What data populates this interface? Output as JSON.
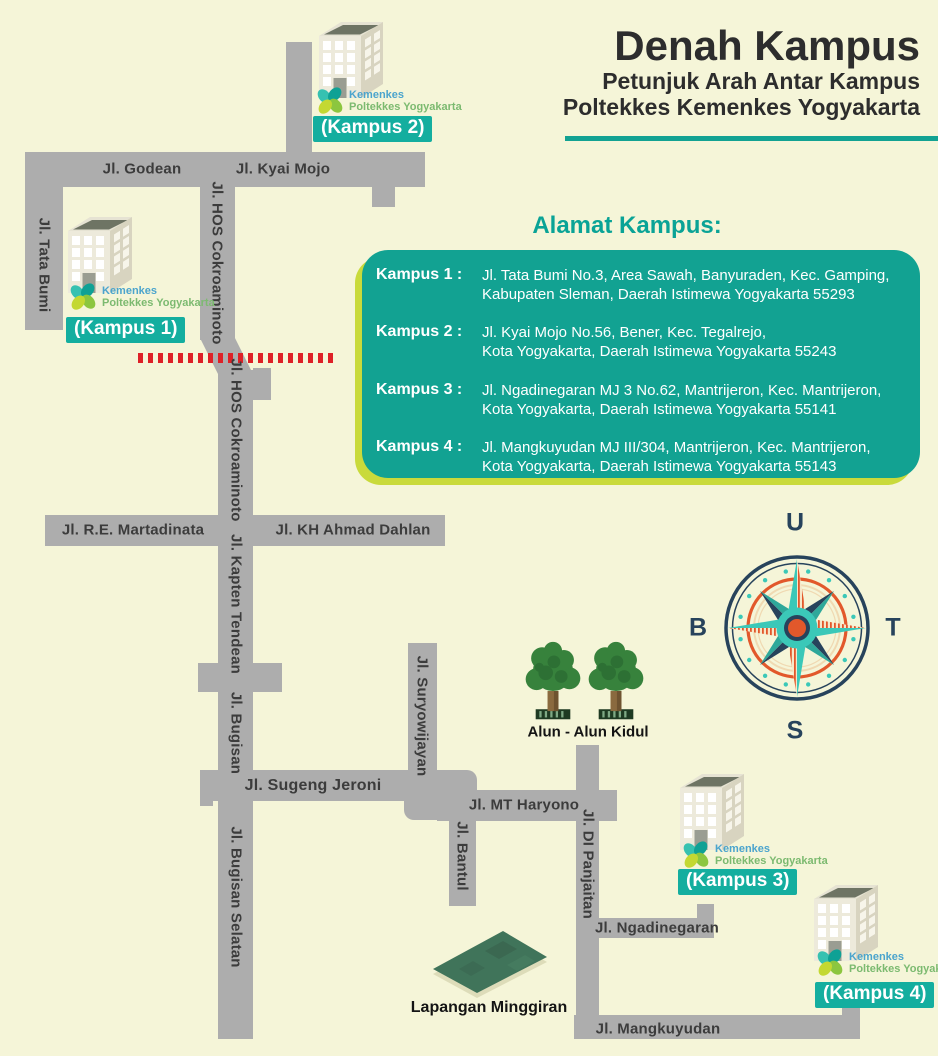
{
  "header": {
    "title": "Denah Kampus",
    "subtitle1": "Petunjuk Arah Antar Kampus",
    "subtitle2": "Poltekkes Kemenkes Yogyakarta"
  },
  "addresses": {
    "heading": "Alamat Kampus:",
    "items": [
      {
        "label": "Kampus 1 :",
        "line1": "Jl. Tata Bumi No.3, Area Sawah, Banyuraden, Kec. Gamping,",
        "line2": "Kabupaten Sleman, Daerah Istimewa Yogyakarta 55293"
      },
      {
        "label": "Kampus 2 :",
        "line1": "Jl. Kyai Mojo No.56, Bener, Kec. Tegalrejo,",
        "line2": "Kota Yogyakarta, Daerah Istimewa Yogyakarta 55243"
      },
      {
        "label": "Kampus 3 :",
        "line1": "Jl. Ngadinegaran MJ 3 No.62, Mantrijeron, Kec. Mantrijeron,",
        "line2": "Kota Yogyakarta, Daerah Istimewa Yogyakarta 55141"
      },
      {
        "label": "Kampus 4 :",
        "line1": "Jl. Mangkuyudan MJ III/304, Mantrijeron, Kec. Mantrijeron,",
        "line2": "Kota Yogyakarta, Daerah Istimewa Yogyakarta 55143"
      }
    ]
  },
  "streets": {
    "godean": "Jl. Godean",
    "kyai_mojo": "Jl. Kyai Mojo",
    "tata_bumi": "Jl. Tata Bumi",
    "hos_upper": "Jl. HOS Cokroaminoto",
    "hos_lower": "Jl. HOS Cokroaminoto",
    "martadinata": "Jl. R.E. Martadinata",
    "ahmad_dahlan": "Jl. KH Ahmad Dahlan",
    "kapten_tendean": "Jl. Kapten Tendean",
    "bugisan": "Jl. Bugisan",
    "bugisan_selatan": "Jl. Bugisan Selatan",
    "sugeng_jeroni": "Jl. Sugeng Jeroni",
    "suryowijayan": "Jl. Suryowijayan",
    "bantul": "Jl. Bantul",
    "mt_haryono": "Jl. MT Haryono",
    "di_panjaitan": "Jl. DI Panjaitan",
    "ngadinegaran": "Jl. Ngadinegaran",
    "mangkuyudan": "Jl. Mangkuyudan"
  },
  "campuses": [
    {
      "label": "(Kampus 1)"
    },
    {
      "label": "(Kampus 2)"
    },
    {
      "label": "(Kampus 3)"
    },
    {
      "label": "(Kampus 4)"
    }
  ],
  "logo": {
    "line1": "Kemenkes",
    "line2": "Poltekkes Yogyakarta"
  },
  "landmarks": {
    "alun_alun": "Alun - Alun Kidul",
    "lapangan": "Lapangan Minggiran"
  },
  "compass": {
    "north": "U",
    "east": "T",
    "south": "S",
    "west": "B"
  },
  "colors": {
    "background": "#F5F5D8",
    "street": "#ADADAD",
    "panel_teal": "#12A292",
    "label_teal": "#14AE9F",
    "lime_shadow": "#C9DA3B",
    "dashed_red": "#DE2127",
    "compass_navy": "#27435C",
    "compass_teal": "#3BC8B8",
    "compass_orange": "#E2582B",
    "logo_blue": "#4BA4CD",
    "logo_green": "#7CBA70"
  }
}
